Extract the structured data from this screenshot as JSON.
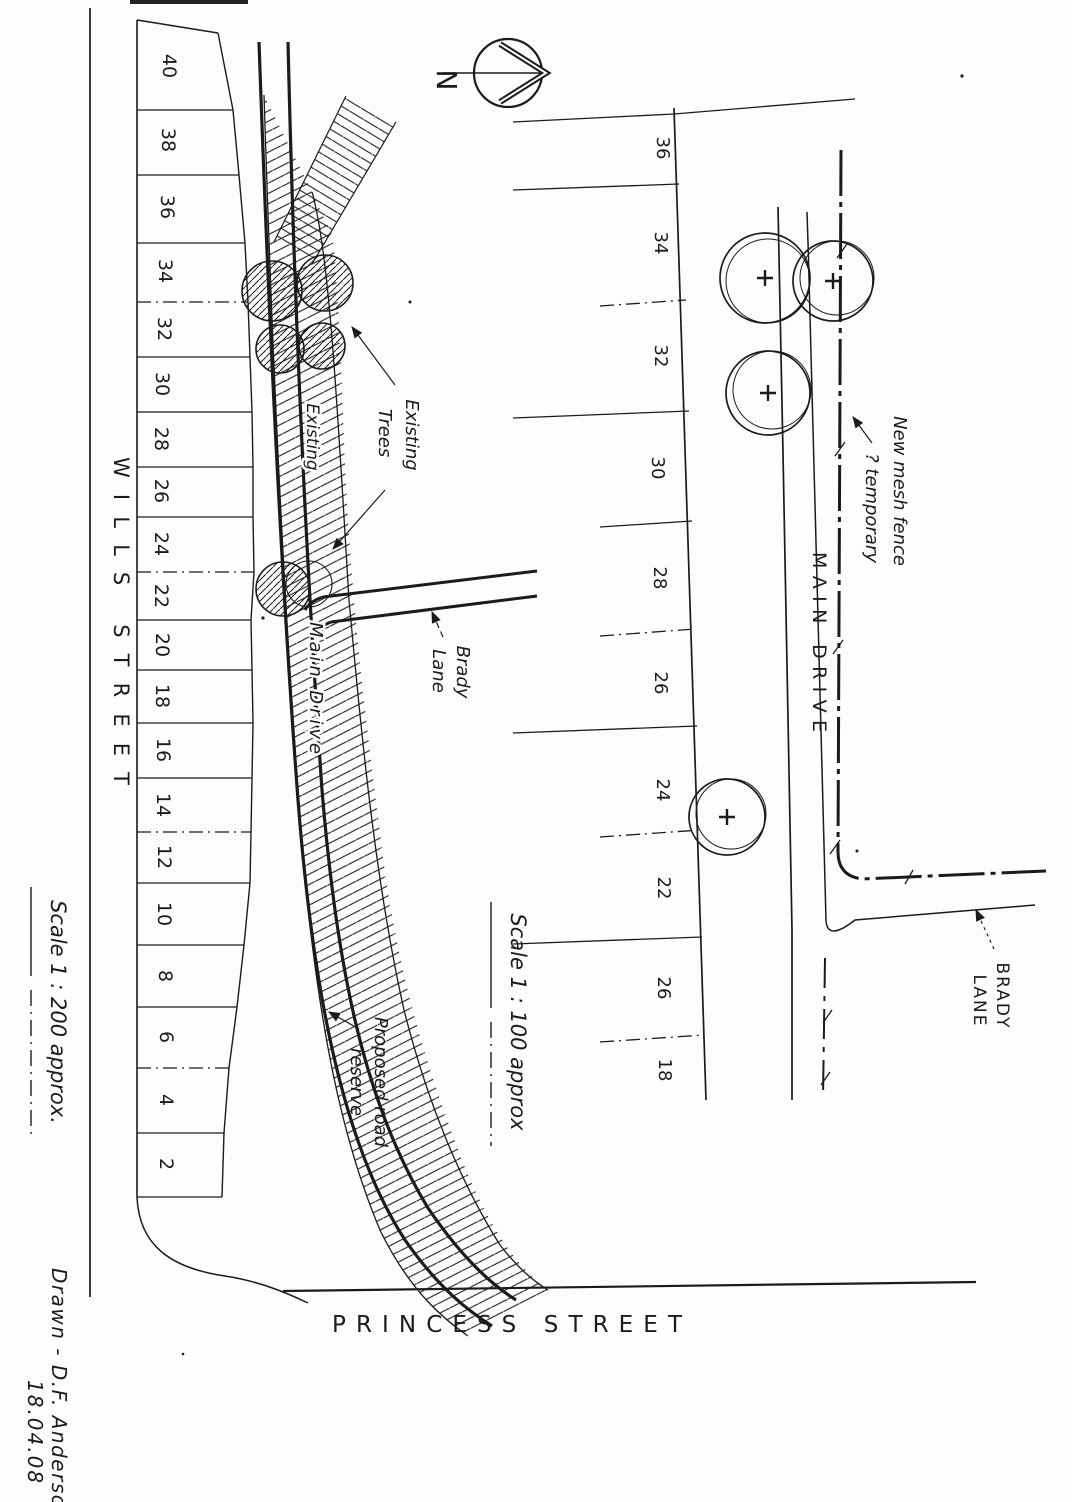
{
  "drawing": {
    "compass": {
      "north_label": "N"
    },
    "left_plan": {
      "wills_street": "WILLS STREET",
      "princess_street": "PRINCESS STREET",
      "lot_numbers": [
        "40",
        "38",
        "36",
        "34",
        "32",
        "30",
        "28",
        "26",
        "24",
        "22",
        "20",
        "18",
        "16",
        "14",
        "12",
        "10",
        "8",
        "6",
        "4",
        "2"
      ],
      "existing_label": "Existing",
      "main_drive_label": "Main Drive",
      "brady_lane": [
        "Brady",
        "Lane"
      ],
      "existing_trees": [
        "Existing",
        "Trees"
      ],
      "proposed_road": [
        "Proposed road",
        "reserve"
      ],
      "scale": "Scale 1 : 200 approx."
    },
    "right_plan": {
      "lot_numbers": [
        "36",
        "34",
        "32",
        "30",
        "28",
        "26",
        "24",
        "22",
        "26",
        "18"
      ],
      "main_drive": "MAIN DRIVE",
      "brady_lane": [
        "BRADY",
        "LANE"
      ],
      "fence_note": [
        "New mesh fence",
        "? temporary"
      ],
      "scale": "Scale 1 : 100 approx"
    },
    "footer": {
      "drawn_by": "Drawn - D.F. Anderso",
      "date": "18.04.08"
    },
    "colors": {
      "ink": "#1b1b1b",
      "paper": "#fdfdfc"
    }
  }
}
